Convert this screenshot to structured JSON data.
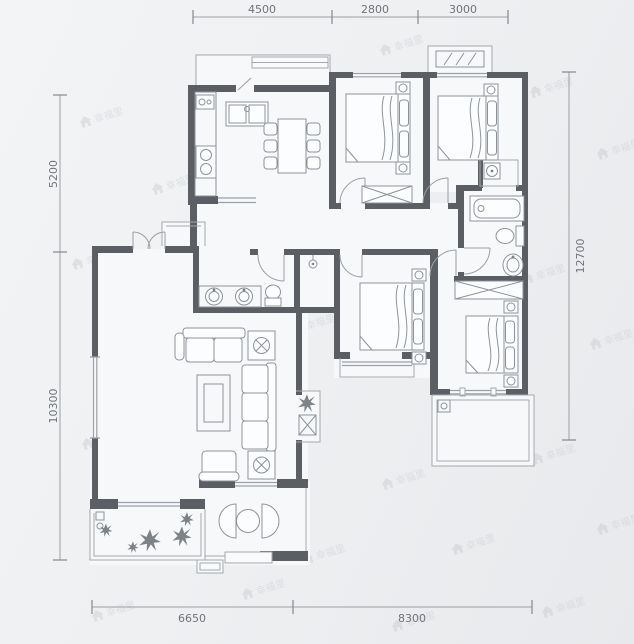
{
  "image": {
    "type": "apartment-floor-plan"
  },
  "dimensions": {
    "top": [
      "4500",
      "2800",
      "3000"
    ],
    "bottom": [
      "6650",
      "8300"
    ],
    "left": [
      "5200",
      "10300"
    ],
    "right": [
      "12700"
    ]
  },
  "watermark": {
    "icon": "house-icon",
    "text": "幸福里"
  },
  "colors": {
    "background": "#eef0f2",
    "wall": "#5b5e63",
    "thin_line": "#a4a8ad",
    "furniture_line": "#8e9399",
    "dimension_text": "#70747a",
    "watermark": "#c7cacf"
  }
}
